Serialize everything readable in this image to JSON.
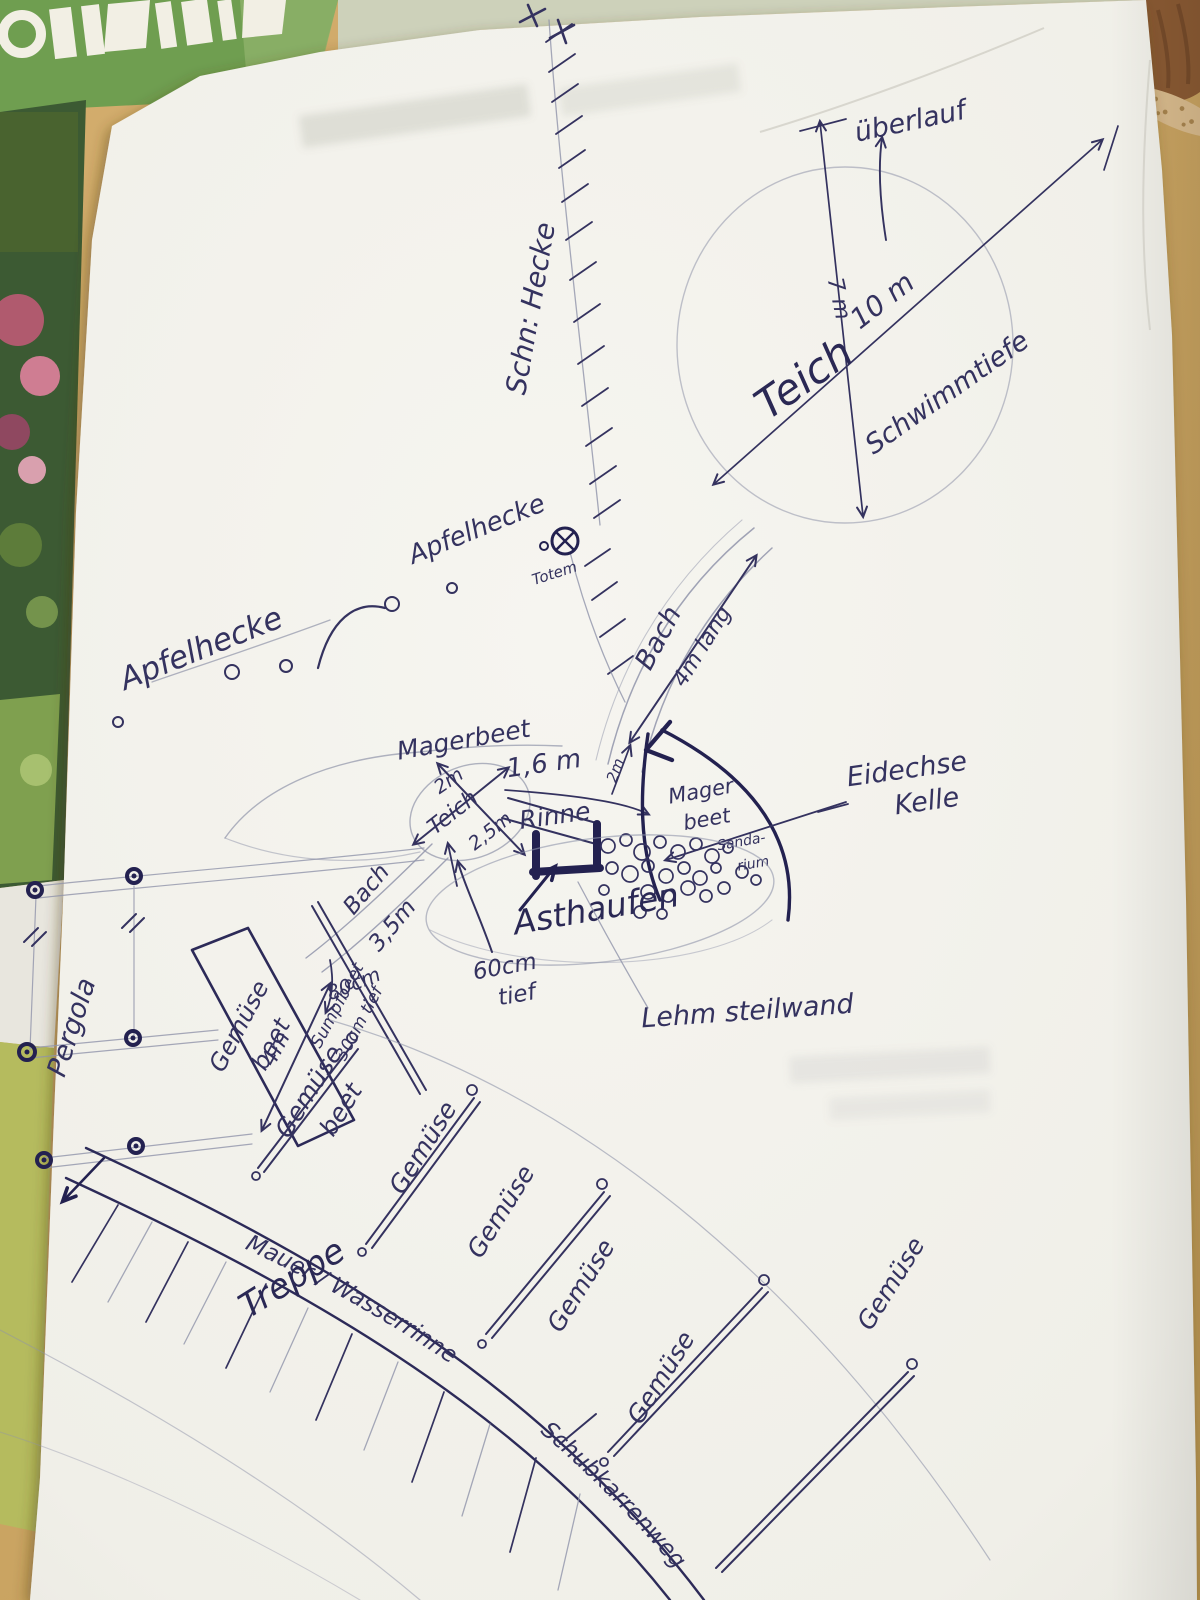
{
  "photo": {
    "colors": {
      "ink": "#34325f",
      "ink_bold": "#232150",
      "pencil": "#9094aa",
      "paper": "#f4f3ee",
      "table": "#c9a362",
      "magazine_green": "#6f9e50",
      "photo_strip_green": "#3c5a33",
      "lower_strip_green": "#b5bb5e",
      "pot_brown": "#8a5a33"
    }
  },
  "labels": {
    "big_pond": {
      "name": "Teich",
      "type_note": "Schwimmtiefe",
      "overflow": "überlauf",
      "width": "7 m",
      "diameter": "10 m"
    },
    "hedge_line": {
      "label": "Schn: Hecke"
    },
    "gate_symbol": {
      "label": "Totem"
    },
    "apple_hedge": {
      "upper": "Apfelhecke",
      "lower": "Apfelhecke"
    },
    "stream_upper": {
      "name": "Bach",
      "length": "4m lang",
      "width": "2m"
    },
    "small_pond": {
      "name": "Teich",
      "dim_a": "2m",
      "dim_b": "2,5m"
    },
    "channel": {
      "name": "Rinne",
      "length": "1,6 m"
    },
    "meager_bed_top": {
      "label": "Magerbeet"
    },
    "meager_bed_right": {
      "line1": "Mager",
      "line2": "beet"
    },
    "sandarium": {
      "line1": "Sanda-",
      "line2": "rium"
    },
    "lizard_note": {
      "line1": "Eidechse",
      "line2": "Kelle"
    },
    "branch_pile": {
      "label": "Asthaufen"
    },
    "pond_depth": {
      "line1": "60cm",
      "line2": "tief"
    },
    "clay_wall": {
      "label": "Lehm steilwand"
    },
    "stream_lower": {
      "name": "Bach",
      "length": "3,5m"
    },
    "pergola": {
      "label": "Pergola"
    },
    "veg_bed_strip": {
      "line1": "Gemüse",
      "line2": "beet"
    },
    "swamp_bed": {
      "line1": "Sumpfbeet",
      "line2": "30cm tief"
    },
    "strip_length": "4m",
    "strip_depth": "80cm",
    "radial_beds": {
      "bed1_line1": "Gemüse",
      "bed1_line2": "beet",
      "bed2": "Gemüse",
      "bed3": "Gemüse",
      "bed4": "Gemüse",
      "bed5": "Gemüse",
      "bed6": "Gemüse"
    },
    "wall_band": {
      "segment1": "Mauer / Wasserrinne",
      "segment2": "Schubkarrenweg"
    },
    "stairs": {
      "label": "Treppe"
    }
  }
}
